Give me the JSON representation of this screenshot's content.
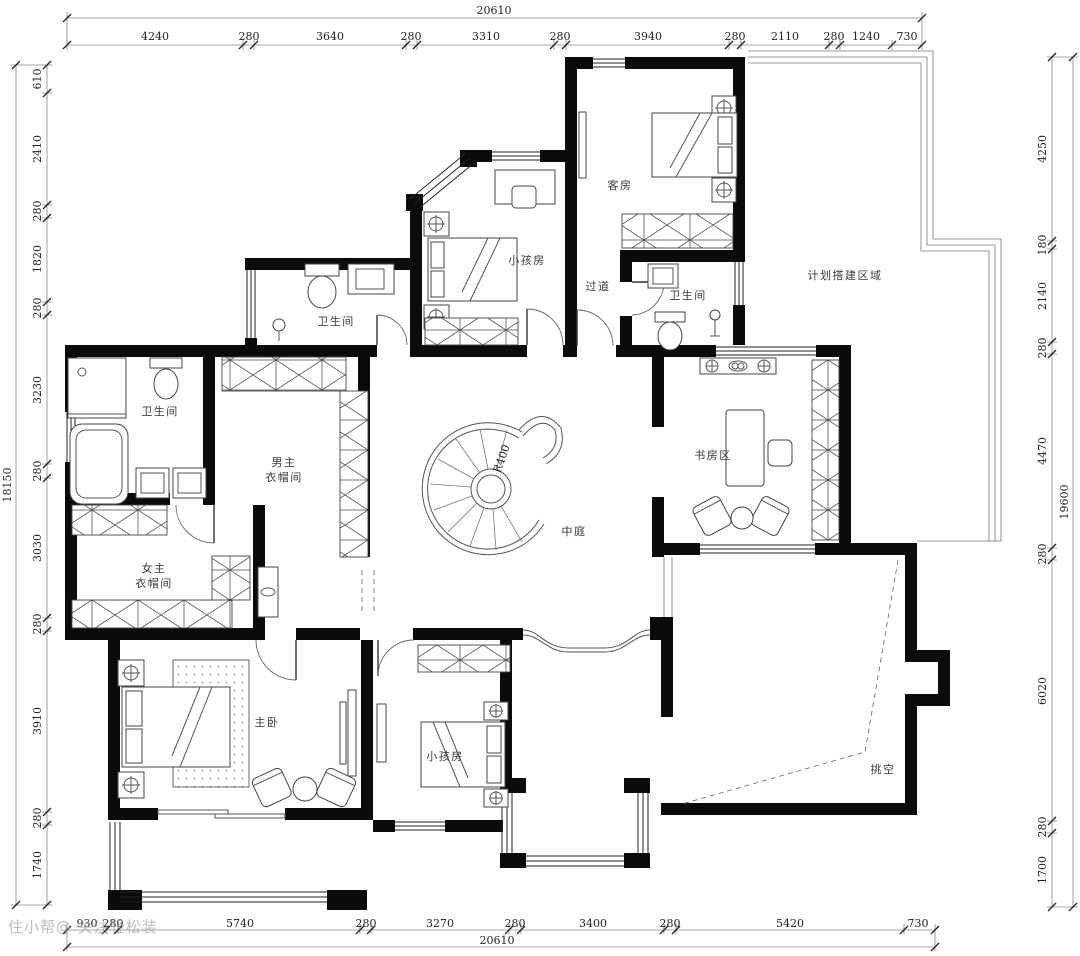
{
  "rooms": {
    "guest": "客房",
    "kids_top": "小孩房",
    "corridor": "过道",
    "bath_top_right": "卫生间",
    "bath_top_left": "卫生间",
    "planned_area": "计划搭建区域",
    "master_bath": "卫生间",
    "his_closet_line1": "男主",
    "his_closet_line2": "衣帽间",
    "her_closet_line1": "女主",
    "her_closet_line2": "衣帽间",
    "study": "书房区",
    "atrium": "中庭",
    "master": "主卧",
    "kids_bottom": "小孩房",
    "void": "挑空"
  },
  "stair": {
    "radius_label": "R400"
  },
  "dims": {
    "top": {
      "total": "20610",
      "segments": [
        "4240",
        "280",
        "3640",
        "280",
        "3310",
        "280",
        "3940",
        "280",
        "2110",
        "280",
        "1240",
        "730"
      ]
    },
    "bottom": {
      "total": "20610",
      "segments": [
        "930",
        "280",
        "5740",
        "280",
        "3270",
        "280",
        "3400",
        "280",
        "5420",
        "730"
      ]
    },
    "left": {
      "total": "18150",
      "segments": [
        "610",
        "2410",
        "280",
        "1820",
        "280",
        "3230",
        "280",
        "3030",
        "280",
        "3910",
        "280",
        "1740"
      ]
    },
    "right": {
      "total": "19600",
      "segments": [
        "4250",
        "180",
        "2140",
        "280",
        "4470",
        "280",
        "6020",
        "280",
        "1700"
      ]
    }
  },
  "watermark": "住小帮@ 关注轻松装"
}
